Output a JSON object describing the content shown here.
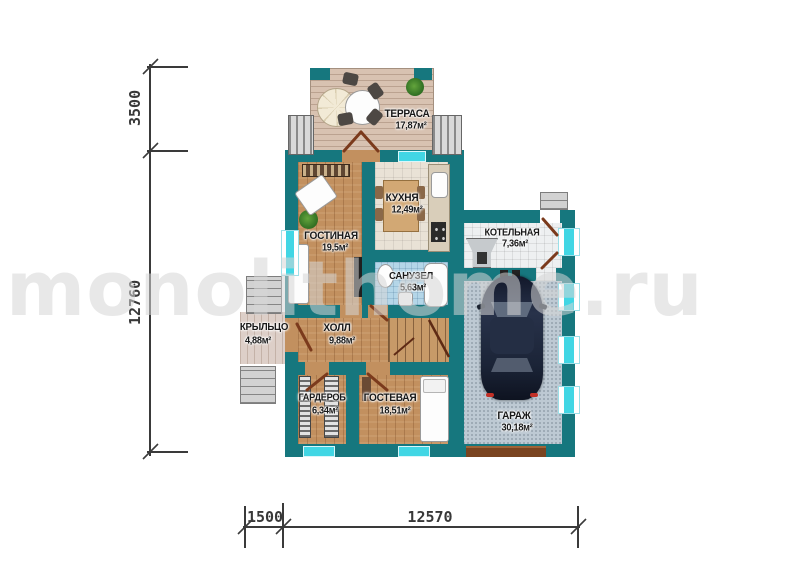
{
  "watermark": "monolithome.ru",
  "dimensions": {
    "top_left_vertical": "3500",
    "left_vertical": "12760",
    "bottom_left": "1500",
    "bottom_main": "12570"
  },
  "rooms": {
    "terrace": {
      "label": "ТЕРРАСА",
      "area": "17,87м²"
    },
    "kitchen": {
      "label": "КУХНЯ",
      "area": "12,49м²"
    },
    "living": {
      "label": "ГОСТИНАЯ",
      "area": "19,5м²"
    },
    "boiler": {
      "label": "КОТЕЛЬНАЯ",
      "area": "7,36м²"
    },
    "bathroom": {
      "label": "САНУЗЕЛ",
      "area": "5,63м²"
    },
    "hall": {
      "label": "ХОЛЛ",
      "area": "9,88м²"
    },
    "porch": {
      "label": "КРЫЛЬЦО",
      "area": "4,88м²"
    },
    "wardrobe": {
      "label": "ГАРДЕРОБ",
      "area": "6,34м²"
    },
    "guest": {
      "label": "ГОСТЕВАЯ",
      "area": "18,51м²"
    },
    "garage": {
      "label": "ГАРАЖ",
      "area": "30,18м²"
    }
  },
  "colors": {
    "wall": "#16777e",
    "window_glass": "#41d6e4",
    "door": "#7b3a1c",
    "wood_floor": "#c2905f",
    "garage_floor": "#bdc9d3",
    "dimension_lines": "#3a3a3a"
  }
}
